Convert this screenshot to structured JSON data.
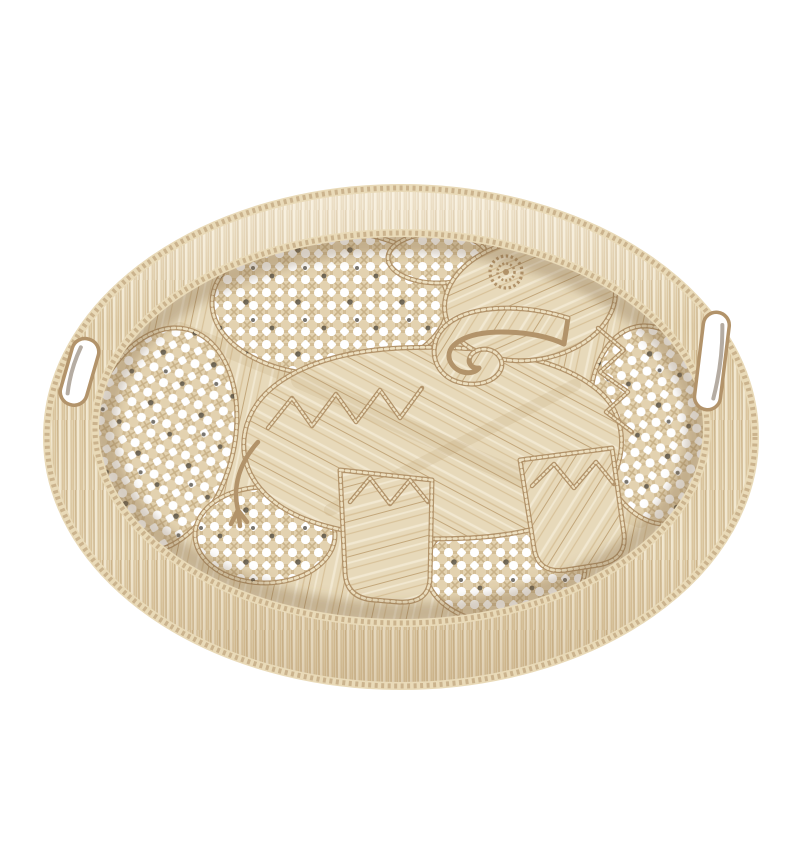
{
  "scene": {
    "alt": "Round handwoven natural raffia tray with an elephant motif woven in raffia over an open cane webbing base, decorative zigzag stitching, a fringed raffia rim with braided edges, and two cut-out carry handles, photographed on a plain white background",
    "subject": "round woven raffia serving tray",
    "motif": "elephant with spiral eye and zigzag trim",
    "material": "natural raffia and open cane webbing",
    "background": "plain white",
    "handle_count": 2,
    "parts": [
      "fringed raffia rim",
      "braided outer edge",
      "braided inner edge",
      "open cane webbing base",
      "raffia elephant body",
      "elephant head",
      "spiral eye",
      "curled trunk",
      "zigzag ear trim",
      "front leg",
      "hind leg",
      "tail",
      "left handle cut-out",
      "right handle cut-out"
    ]
  },
  "palette": {
    "background": "#ffffff",
    "fringe_base": "#e9dcbf",
    "raffia_base": "#e7d9ba",
    "strand_pale": "#f2e8d1",
    "strand_mid": "#d8c29a",
    "strand_dark": "#bfa274",
    "web_base": "#e3d2b0",
    "web_strand": "#d3bd95",
    "web_diag": "#c9b289",
    "braid": "#e9dab8",
    "cord_dark": "#b2936a",
    "cord_light": "#ecdfc0",
    "hole_shadow": "#4a453c"
  }
}
